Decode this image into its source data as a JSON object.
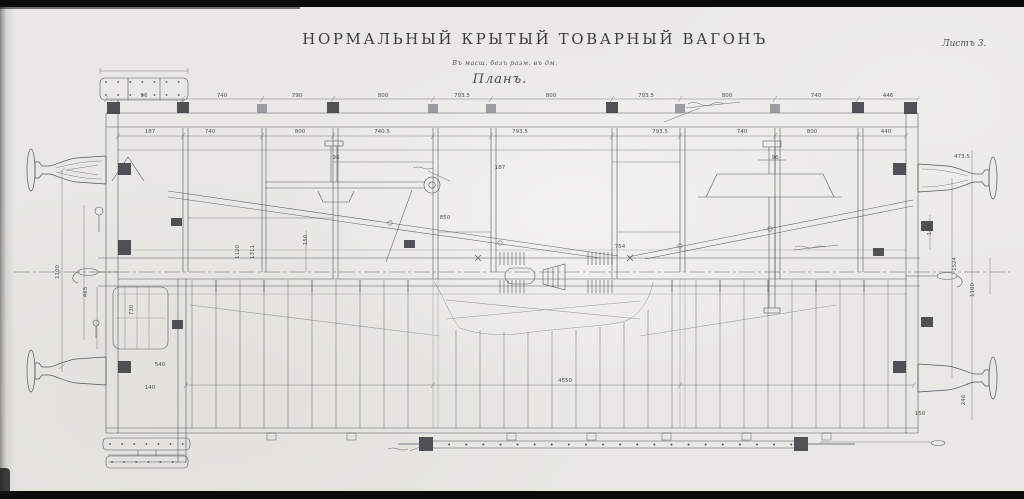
{
  "header": {
    "title": "НОРМАЛЬНЫЙ КРЫТЫЙ ТОВАРНЫЙ ВАГОНЪ",
    "subtitle": "Въ масш. безъ разм. въ дм.",
    "view_label": "Планъ.",
    "sheet_label": "Листъ 3."
  },
  "colors": {
    "paper": "#e9e8e4",
    "ink": "#474b55",
    "dark_fill": "#3a3c42",
    "band": "#0b0b0b"
  },
  "drawing": {
    "name": "Планъ нормальнаго крытаго товарнаго вагона",
    "dimensions": [
      {
        "x": 144,
        "y": 96,
        "t": "96"
      },
      {
        "x": 222,
        "y": 96,
        "t": "740"
      },
      {
        "x": 297,
        "y": 96,
        "t": "790"
      },
      {
        "x": 383,
        "y": 96,
        "t": "800"
      },
      {
        "x": 462,
        "y": 96,
        "t": "793.5"
      },
      {
        "x": 551,
        "y": 96,
        "t": "800"
      },
      {
        "x": 646,
        "y": 96,
        "t": "793.5"
      },
      {
        "x": 727,
        "y": 96,
        "t": "800"
      },
      {
        "x": 816,
        "y": 96,
        "t": "740"
      },
      {
        "x": 888,
        "y": 96,
        "t": "446"
      },
      {
        "x": 150,
        "y": 132,
        "t": "187"
      },
      {
        "x": 210,
        "y": 132,
        "t": "740"
      },
      {
        "x": 300,
        "y": 132,
        "t": "800"
      },
      {
        "x": 382,
        "y": 132,
        "t": "740.5"
      },
      {
        "x": 520,
        "y": 132,
        "t": "793.5"
      },
      {
        "x": 660,
        "y": 132,
        "t": "793.5"
      },
      {
        "x": 742,
        "y": 132,
        "t": "740"
      },
      {
        "x": 812,
        "y": 132,
        "t": "800"
      },
      {
        "x": 886,
        "y": 132,
        "t": "440"
      },
      {
        "x": 565,
        "y": 381,
        "t": "4550"
      },
      {
        "x": 238,
        "y": 252,
        "t": "1120",
        "r": -90
      },
      {
        "x": 253,
        "y": 252,
        "t": "1311",
        "r": -90
      },
      {
        "x": 306,
        "y": 240,
        "t": "150",
        "r": -90
      },
      {
        "x": 58,
        "y": 272,
        "t": "1100",
        "r": -90
      },
      {
        "x": 86,
        "y": 292,
        "t": "465",
        "r": -90
      },
      {
        "x": 955,
        "y": 264,
        "t": "1524",
        "r": -90
      },
      {
        "x": 973,
        "y": 290,
        "t": "1100",
        "r": -90
      },
      {
        "x": 962,
        "y": 157,
        "t": "473.5"
      },
      {
        "x": 930,
        "y": 230,
        "t": "140",
        "r": -90
      },
      {
        "x": 445,
        "y": 218,
        "t": "850"
      },
      {
        "x": 620,
        "y": 247,
        "t": "754"
      },
      {
        "x": 500,
        "y": 168,
        "t": "187"
      },
      {
        "x": 150,
        "y": 388,
        "t": "140"
      },
      {
        "x": 160,
        "y": 365,
        "t": "540"
      },
      {
        "x": 336,
        "y": 158,
        "t": "96"
      },
      {
        "x": 775,
        "y": 158,
        "t": "96"
      },
      {
        "x": 920,
        "y": 414,
        "t": "150"
      },
      {
        "x": 964,
        "y": 400,
        "t": "246",
        "r": -90
      },
      {
        "x": 132,
        "y": 310,
        "t": "730",
        "r": -90
      }
    ]
  }
}
